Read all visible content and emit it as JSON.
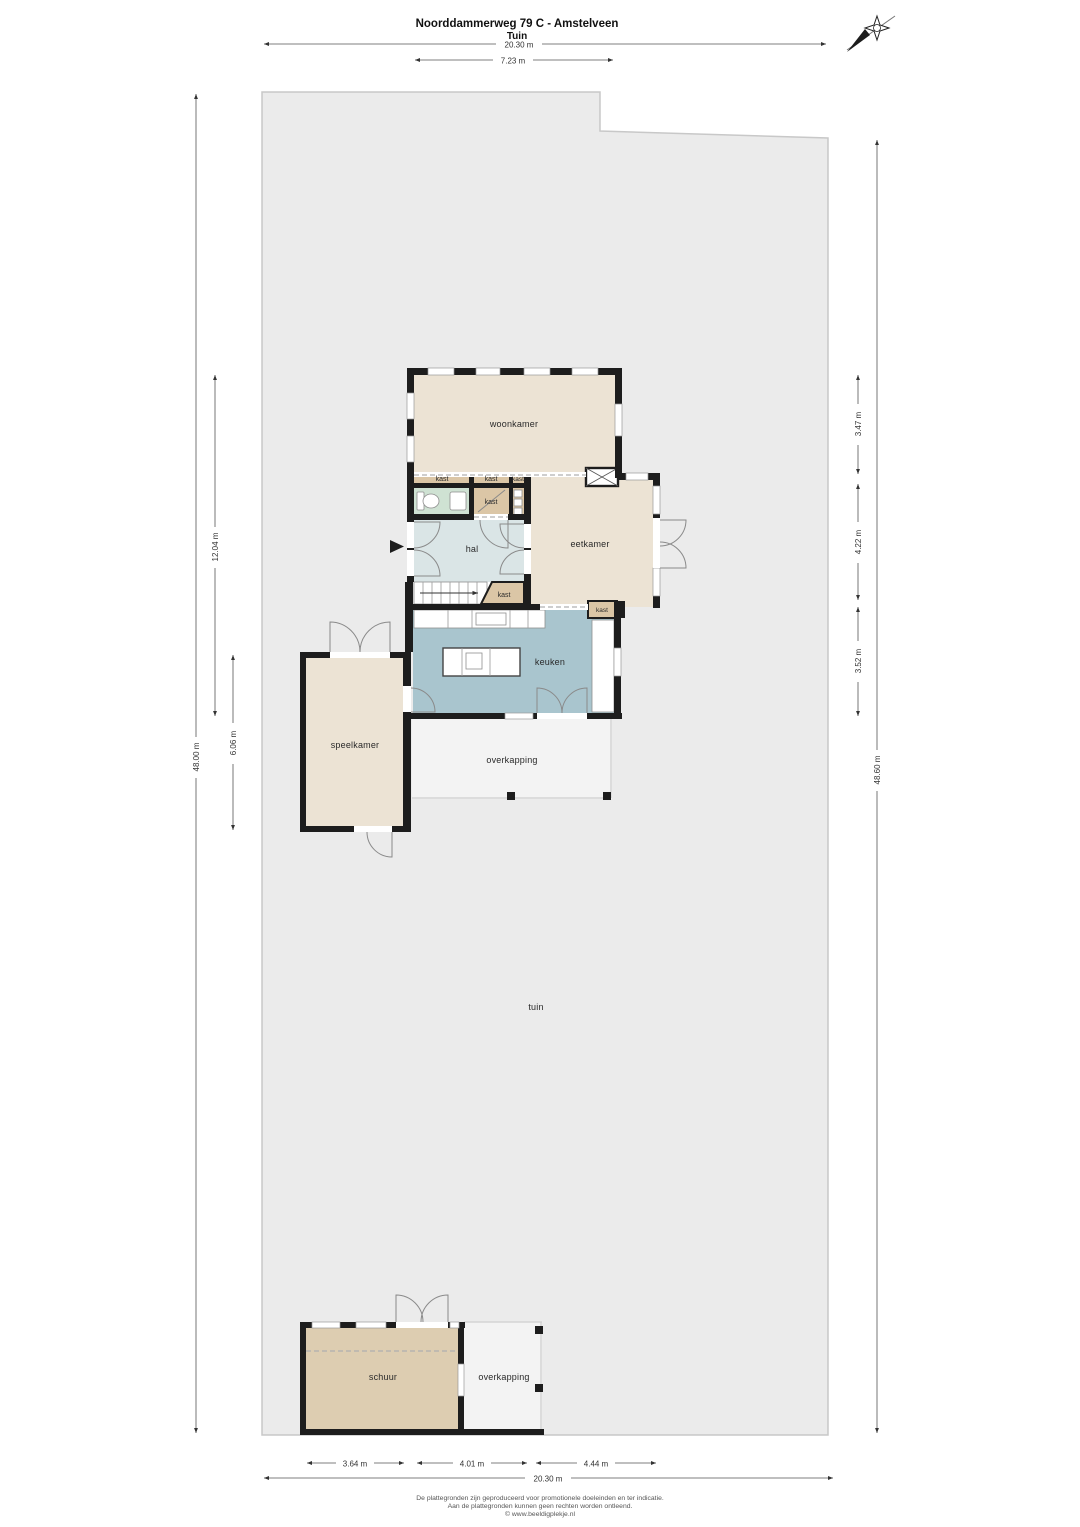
{
  "header": {
    "title": "Noorddammerweg 79 C - Amstelveen",
    "subtitle": "Tuin"
  },
  "compass": {
    "icon": "compass-rose"
  },
  "rooms": {
    "woonkamer": {
      "label": "woonkamer",
      "color": "#ece3d4"
    },
    "eetkamer": {
      "label": "eetkamer",
      "color": "#ece3d4"
    },
    "hal": {
      "label": "hal",
      "color": "#dae5e6"
    },
    "keuken": {
      "label": "keuken",
      "color": "#a9c5ce"
    },
    "speelkamer": {
      "label": "speelkamer",
      "color": "#ece3d4"
    },
    "kast": {
      "label": "kast",
      "color": "#dbc6a6"
    },
    "toilet": {
      "color": "#cfe2d3"
    },
    "schuur": {
      "label": "schuur",
      "color": "#ddcdb1"
    },
    "overkapping_house": {
      "label": "overkapping",
      "color": "#f3f3f3"
    },
    "overkapping_schuur": {
      "label": "overkapping",
      "color": "#f3f3f3"
    },
    "tuin": {
      "label": "tuin",
      "color": "#ebebeb"
    }
  },
  "dimensions": {
    "top_total": "20.30 m",
    "top_house": "7.23 m",
    "left_plot": "48.00 m",
    "left_house": "12.04 m",
    "left_speelkamer": "6.06 m",
    "right_woonkamer": "3.47 m",
    "right_eetkamer": "4.22 m",
    "right_keuken": "3.52 m",
    "right_plot": "48.60 m",
    "bottom_schuur": "3.64 m",
    "bottom_overkapping": "4.01 m",
    "bottom_right": "4.44 m",
    "bottom_total": "20.30 m"
  },
  "footer": {
    "line1": "De plattegronden zijn geproduceerd voor promotionele doeleinden en ter indicatie.",
    "line2": "Aan de plattegronden kunnen geen rechten worden ontleend.",
    "line3": "© www.beeldigplekje.nl"
  }
}
